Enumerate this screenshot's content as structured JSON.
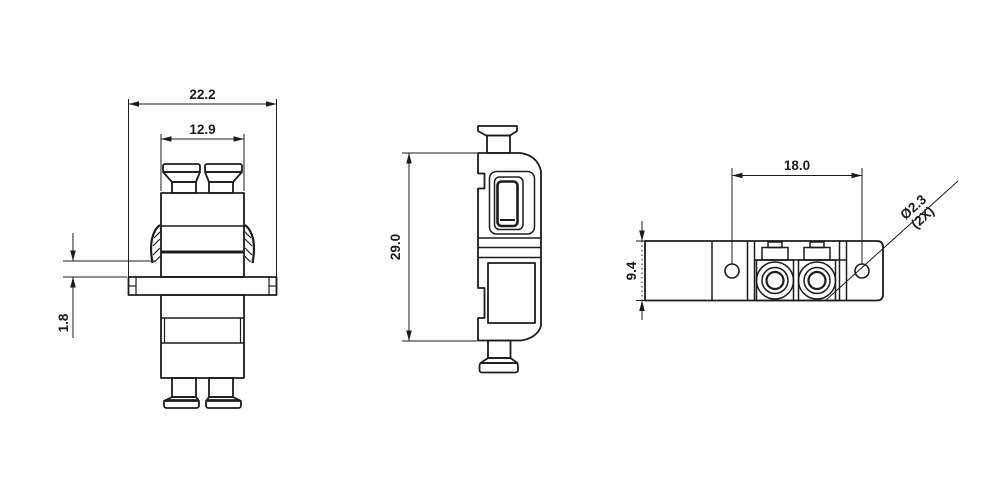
{
  "drawing": {
    "colors": {
      "background": "#ffffff",
      "line": "#1c1c1c"
    },
    "views": {
      "front": {
        "flange_width": "22.2",
        "body_width": "12.9",
        "latch_gap": "1.8"
      },
      "side": {
        "height": "29.0"
      },
      "top": {
        "hole_spacing": "18.0",
        "body_depth": "9.4",
        "hole_diameter": "Ø2.3",
        "hole_quantity": "(2X)"
      }
    }
  }
}
